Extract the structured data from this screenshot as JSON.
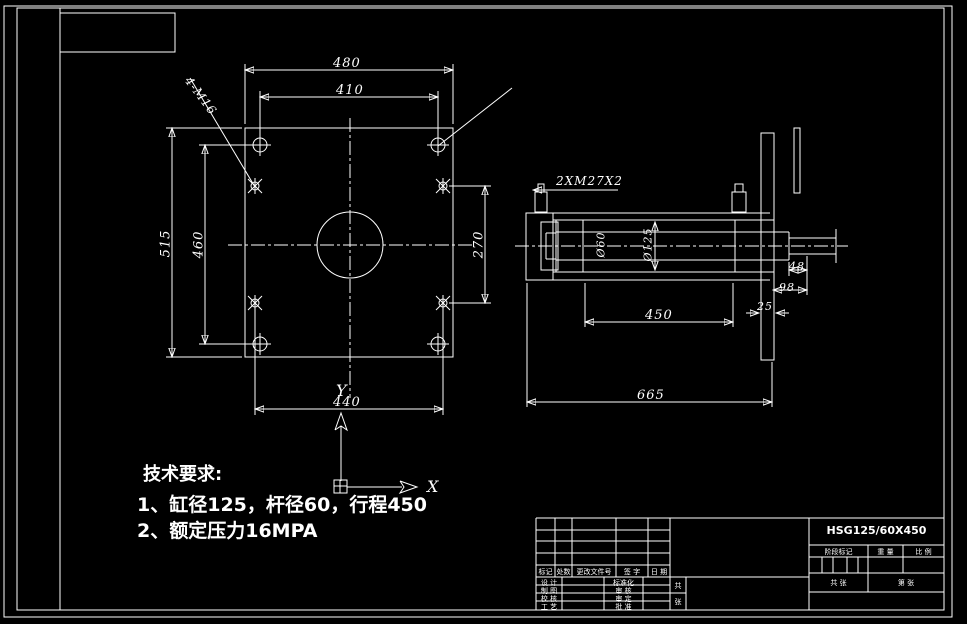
{
  "tech": {
    "title": "技术要求:",
    "line1": "1、缸径125，杆径60，行程450",
    "line2": "2、额定压力16MPA"
  },
  "left_view": {
    "d480": "480",
    "d410": "410",
    "d515": "515",
    "d460": "460",
    "d270": "270",
    "d440": "440",
    "hole_label": "4-M16"
  },
  "right_view": {
    "port_label": "2XM27X2",
    "rod_dia": "Ø60",
    "bore_dia": "Ø125",
    "d450": "450",
    "d665": "665",
    "d48": "48",
    "d98": "98",
    "d25": "25"
  },
  "axes": {
    "x": "X",
    "y": "Y"
  },
  "title_block": {
    "part_no": "HSG125/60X450",
    "h1": "标记",
    "h2": "处数",
    "h3": "更改文件号",
    "h4": "签 字",
    "h5": "日 期",
    "l1": "设 计",
    "l2": "制 图",
    "l3": "校 核",
    "l4": "工 艺",
    "m1": "标准化",
    "m2": "审 核",
    "m3": "审 定",
    "m4": "批 准",
    "stage": "阶段标记",
    "weight": "重 量",
    "scale": "比 例",
    "sheets": "共 张",
    "sheet_no": "第 张",
    "v1": "共",
    "v2": "张"
  }
}
